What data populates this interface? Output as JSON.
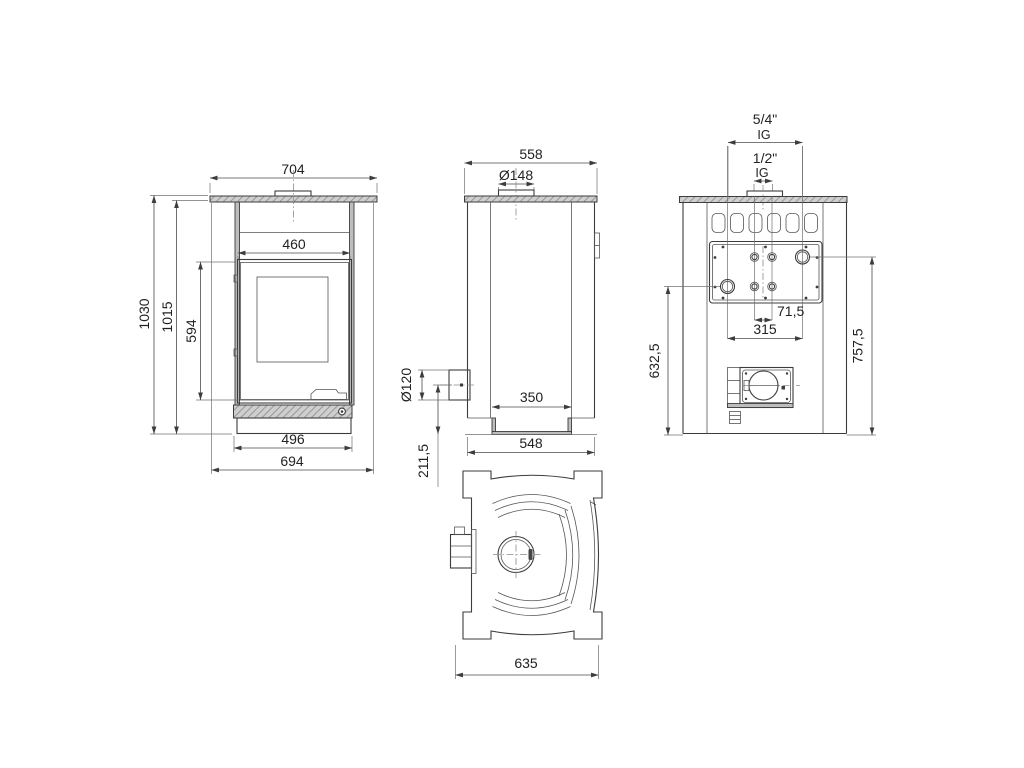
{
  "meta": {
    "type": "technical-dimension-drawing",
    "subject": "stove orthographic views"
  },
  "colors": {
    "background": "#ffffff",
    "line": "#3c3c3c",
    "hatch_fill": "#cfcfcf",
    "panel_gray": "#bdbdbd"
  },
  "front_view": {
    "width_top": "704",
    "door_width": "460",
    "height_total": "1030",
    "height_body": "1015",
    "door_height": "594",
    "base_width": "496",
    "width_bottom": "694"
  },
  "side_view": {
    "depth_top": "558",
    "flue_diameter": "Ø148",
    "outlet_diameter": "Ø120",
    "inner_depth": "350",
    "depth_bottom": "548",
    "outlet_height": "211,5"
  },
  "rear_view": {
    "fitting_large": "5/4\"",
    "fitting_large_thread": "IG",
    "fitting_small": "1/2\"",
    "fitting_small_thread": "IG",
    "small_fitting_spacing": "71,5",
    "large_fitting_spacing": "315",
    "height_left": "632,5",
    "height_right": "757,5"
  },
  "top_view": {
    "width": "635"
  }
}
